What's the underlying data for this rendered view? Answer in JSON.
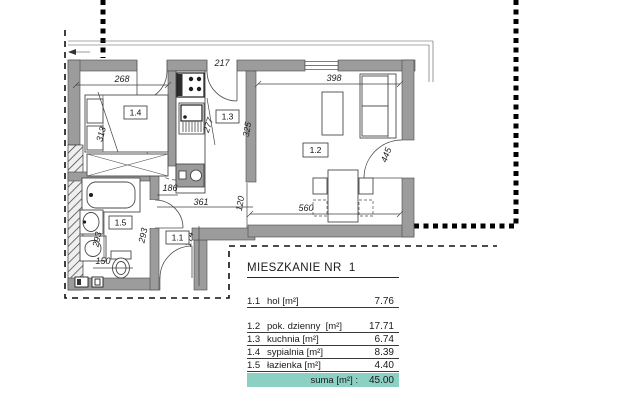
{
  "colors": {
    "wall": "#9c9c9c",
    "suma_bg": "#8ccfc3",
    "line": "#333333"
  },
  "plan": {
    "room_labels": {
      "hall": "1.1",
      "living": "1.2",
      "kitchen": "1.3",
      "bedroom": "1.4",
      "bathroom": "1.5"
    },
    "dims": {
      "bedroom_width": "268",
      "kitchen_width": "217",
      "living_width": "398",
      "bedroom_depth": "313",
      "kitchen_depth": "277",
      "kitchen_wall": "325",
      "balcony_door": "445",
      "hall_width": "186",
      "hall_length": "361",
      "hall_opening": "120",
      "bath_depth_left": "293",
      "bath_depth_right": "293",
      "bath_width": "150",
      "hall_lower": "174",
      "living_bottom": "560"
    }
  },
  "table": {
    "title": "MIESZKANIE NR  1",
    "rows": [
      {
        "no": "1.1",
        "name": "hol [m²]",
        "value": "7.76"
      },
      {
        "no": "1.2",
        "name": "pok. dzienny  [m²]",
        "value": "17.71"
      },
      {
        "no": "1.3",
        "name": "kuchnia [m²]",
        "value": "6.74"
      },
      {
        "no": "1.4",
        "name": "sypialnia [m²]",
        "value": "8.39"
      },
      {
        "no": "1.5",
        "name": "łazienka [m²]",
        "value": "4.40"
      }
    ],
    "total_label": "suma [m²] : ",
    "total_value": "45.00"
  }
}
